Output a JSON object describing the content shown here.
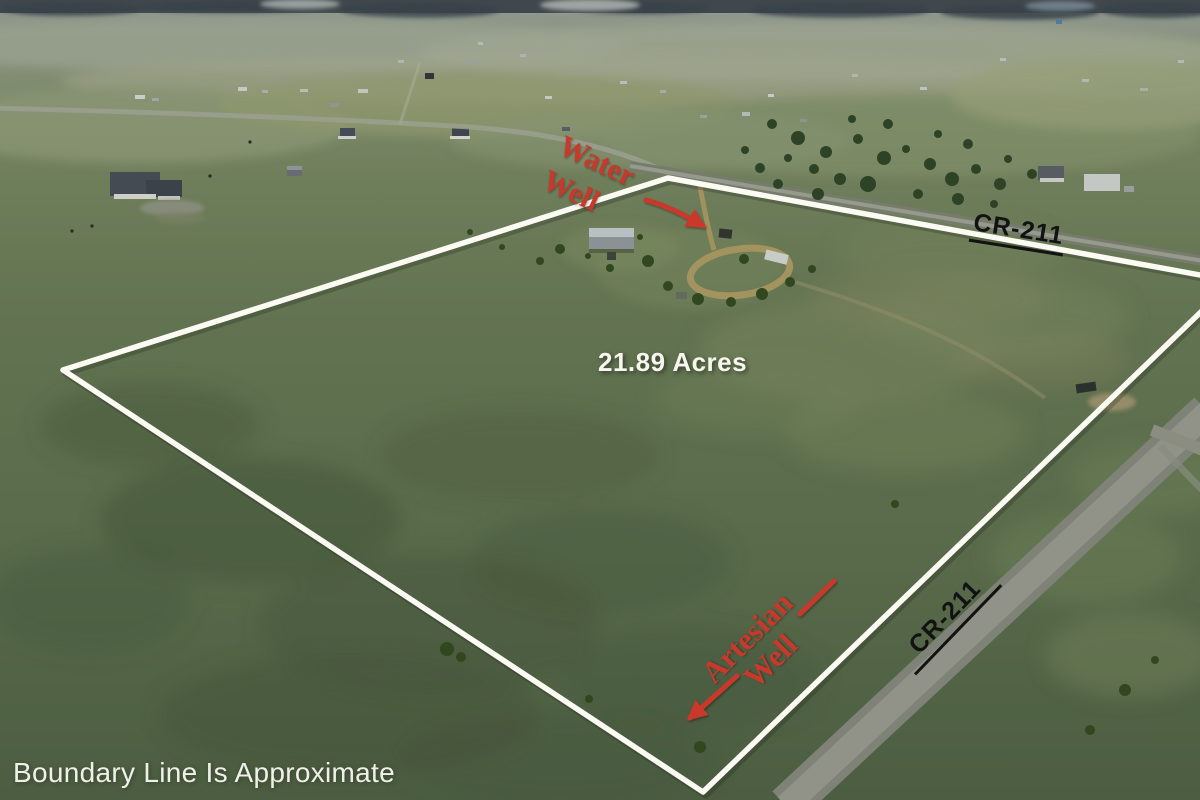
{
  "annotations": {
    "acreage": "21.89 Acres",
    "water_well": {
      "line1": "Water",
      "line2": "Well"
    },
    "artesian_well": {
      "line1": "Artesian",
      "line2": "Well"
    },
    "road_label_top": "CR-211",
    "road_label_bottom": "CR-211",
    "disclaimer": "Boundary Line Is Approximate"
  },
  "colors": {
    "boundary": "#fbfbf4",
    "annotation_red": "#c9392b",
    "road_label": "#121212",
    "white_text": "#f6f6ee"
  }
}
